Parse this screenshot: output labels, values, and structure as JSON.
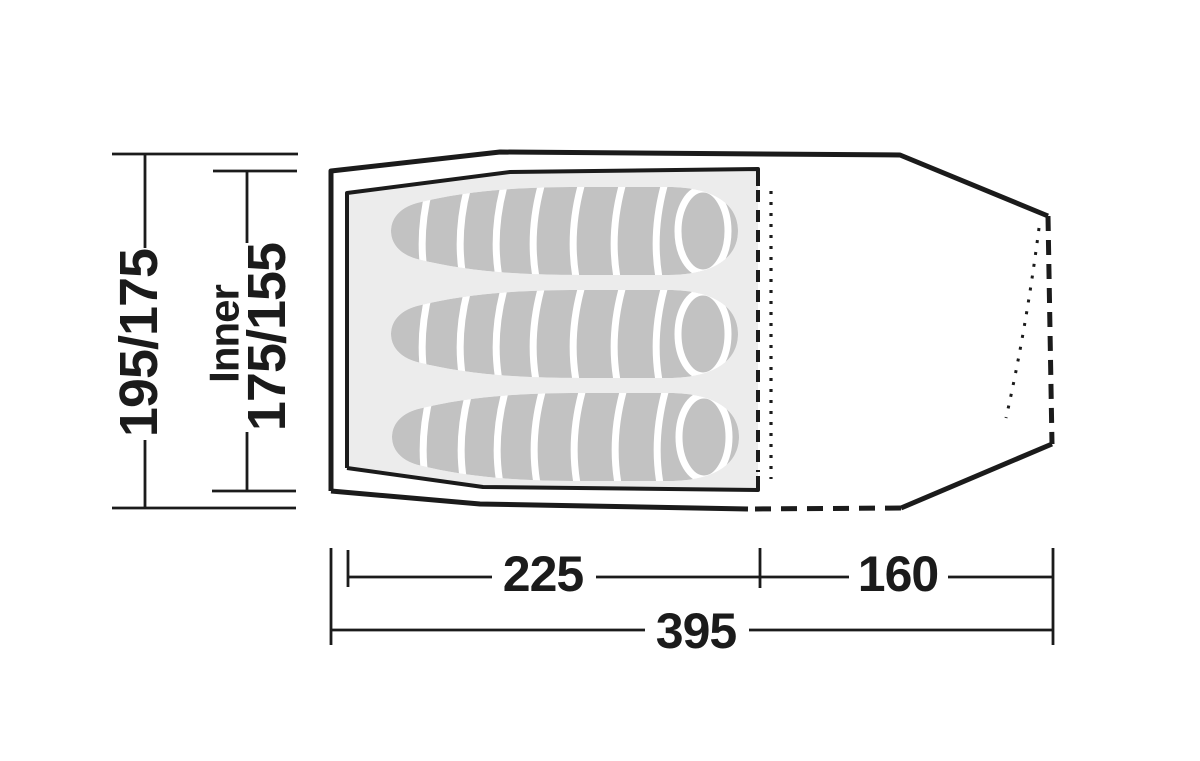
{
  "diagram": {
    "type": "tent-floorplan-top-view",
    "labels": {
      "outer_length_side": "195/175",
      "inner_word": "Inner",
      "inner_length_side": "175/155",
      "inner_width_bottom": "225",
      "porch_width_bottom": "160",
      "total_width_bottom": "395"
    },
    "sleeping_bag_count": 3,
    "colors": {
      "line": "#1b1b1b",
      "inner_floor_fill": "#ececec",
      "sleeping_bag_fill": "#c2c2c2",
      "divider": "#ffffff",
      "background": "#ffffff"
    }
  }
}
